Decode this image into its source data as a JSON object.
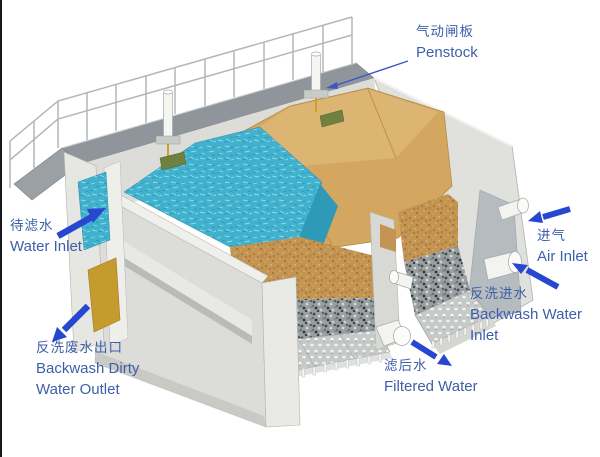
{
  "scene": {
    "background": "#ffffff",
    "description_colors": {
      "water": "#41b1ce",
      "water_dark": "#2f9ab8",
      "sand": "#c49552",
      "mound": "#d3a75f",
      "mound_light": "#ddb573",
      "gravel": "#9aa0a2",
      "concrete": "#dcddd9",
      "walkway": "#8f959a",
      "yellow_outlet": "#c59a2f",
      "gate_green": "#6f8040",
      "arrow": "#2847d0",
      "label_text": "#3d5fa9",
      "railing": "#b3b7ba"
    },
    "labels": {
      "penstock": {
        "zh": "气动闸板",
        "en": "Penstock"
      },
      "water_inlet": {
        "zh": "待滤水",
        "en": "Water Inlet"
      },
      "backwash_dirty_water_outlet": {
        "zh": "反洗废水出口",
        "en_line1": "Backwash Dirty",
        "en_line2": "Water Outlet"
      },
      "air_inlet": {
        "zh": "进气",
        "en": "Air Inlet"
      },
      "backwash_water_inlet": {
        "zh": "反洗进水",
        "en": "Backwash Water Inlet"
      },
      "filtered_water": {
        "zh": "滤后水",
        "en": "Filtered Water"
      }
    }
  }
}
